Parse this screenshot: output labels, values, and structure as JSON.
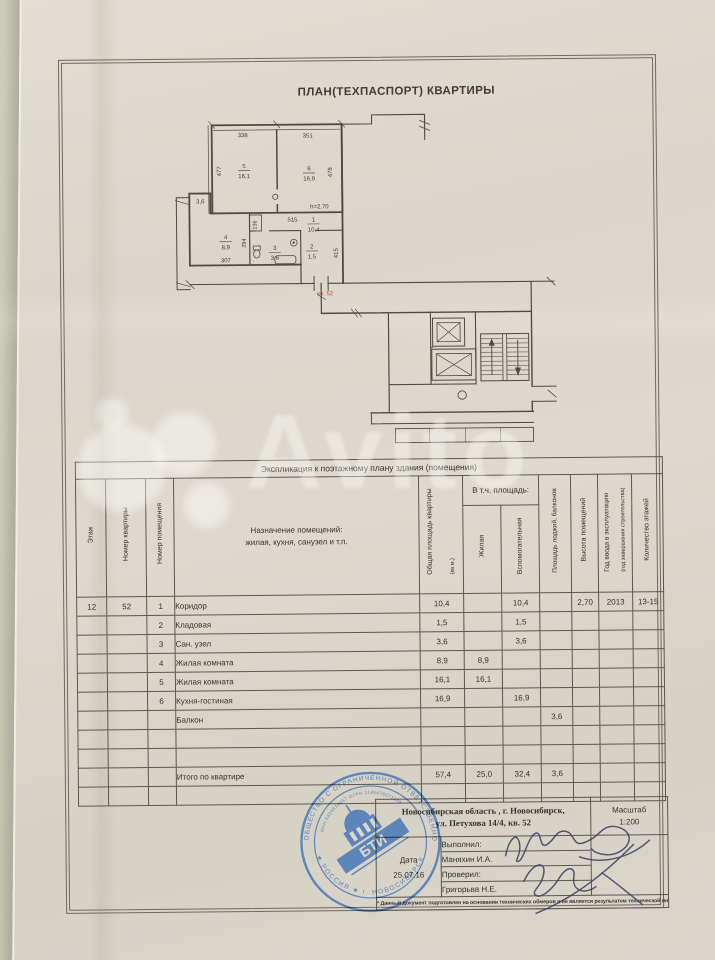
{
  "title": "ПЛАН(ТЕХПАСПОРТ) КВАРТИРЫ",
  "plan": {
    "kv_label": "кв. 52",
    "h_note": "h=2,70",
    "balcony_area": "3,6",
    "rooms": {
      "r5": {
        "num": "5",
        "area": "16,1"
      },
      "r6": {
        "num": "6",
        "area": "16,9"
      },
      "r4": {
        "num": "4",
        "area": "8,9"
      },
      "r3": {
        "num": "3",
        "area": "3,6"
      },
      "r2": {
        "num": "2",
        "area": "1,5"
      },
      "r1": {
        "num": "1",
        "area": "10,4"
      }
    },
    "dims": {
      "top_left": "338",
      "top_right": "351",
      "left": "477",
      "right": "478",
      "hall": "515",
      "hall_v": "415",
      "room4_w": "307",
      "room4_h": "294",
      "duct": "136"
    }
  },
  "table": {
    "caption": "Экспликация к поэтажному плану здания (помещения)",
    "col_floor": "Этаж",
    "col_apt": "Номер квартиры",
    "col_room": "Номер помещения",
    "col_purpose_1": "Назначение помещений:",
    "col_purpose_2": "жилая, кухня, санузел и т.п.",
    "col_total": "Общая площадь квартиры",
    "col_total_sub": "(кв.м.)",
    "col_incl": "В т.ч. площадь:",
    "col_living": "Жилая",
    "col_aux": "Вспомогательная",
    "col_balcony": "Площадь лоджий, балконов",
    "col_height": "Высота помещений",
    "col_year": "Год ввода в эксплуатацию",
    "col_year_sub": "(год завершения строительства)",
    "col_floors": "Количество этажей",
    "rows": [
      {
        "floor": "12",
        "apt": "52",
        "num": "1",
        "name": "Коридор",
        "total": "10,4",
        "living": "",
        "aux": "10,4",
        "balc": "",
        "height": "2,70",
        "year": "2013",
        "floors": "13-15"
      },
      {
        "floor": "",
        "apt": "",
        "num": "2",
        "name": "Кладовая",
        "total": "1,5",
        "living": "",
        "aux": "1,5",
        "balc": "",
        "height": "",
        "year": "",
        "floors": ""
      },
      {
        "floor": "",
        "apt": "",
        "num": "3",
        "name": "Сан. узел",
        "total": "3,6",
        "living": "",
        "aux": "3,6",
        "balc": "",
        "height": "",
        "year": "",
        "floors": ""
      },
      {
        "floor": "",
        "apt": "",
        "num": "4",
        "name": "Жилая комната",
        "total": "8,9",
        "living": "8,9",
        "aux": "",
        "balc": "",
        "height": "",
        "year": "",
        "floors": ""
      },
      {
        "floor": "",
        "apt": "",
        "num": "5",
        "name": "Жилая комната",
        "total": "16,1",
        "living": "16,1",
        "aux": "",
        "balc": "",
        "height": "",
        "year": "",
        "floors": ""
      },
      {
        "floor": "",
        "apt": "",
        "num": "6",
        "name": "Кухня-гостиная",
        "total": "16,9",
        "living": "",
        "aux": "16,9",
        "balc": "",
        "height": "",
        "year": "",
        "floors": ""
      },
      {
        "floor": "",
        "apt": "",
        "num": "",
        "name": "Балкон",
        "total": "",
        "living": "",
        "aux": "",
        "balc": "3,6",
        "height": "",
        "year": "",
        "floors": ""
      },
      {
        "floor": "",
        "apt": "",
        "num": "",
        "name": "",
        "total": "",
        "living": "",
        "aux": "",
        "balc": "",
        "height": "",
        "year": "",
        "floors": ""
      },
      {
        "floor": "",
        "apt": "",
        "num": "",
        "name": "",
        "total": "",
        "living": "",
        "aux": "",
        "balc": "",
        "height": "",
        "year": "",
        "floors": ""
      },
      {
        "floor": "",
        "apt": "",
        "num": "",
        "name": "Итого по квартире",
        "total": "57,4",
        "living": "25,0",
        "aux": "32,4",
        "balc": "3,6",
        "height": "",
        "year": "",
        "floors": ""
      },
      {
        "floor": "",
        "apt": "",
        "num": "",
        "name": "",
        "total": "",
        "living": "",
        "aux": "",
        "balc": "",
        "height": "",
        "year": "",
        "floors": ""
      }
    ]
  },
  "footer": {
    "address1": "Новосибирская область , г. Новосибирск,",
    "address2": "ул. Петухова 14/4, кв. 52",
    "scale_label": "Масштаб",
    "scale_value": "1:200",
    "date_label": "Дата",
    "date_value": "25.07.16",
    "done_label": "Выполнил:",
    "done_name": "Маняхин И.А.",
    "checked_label": "Проверил:",
    "checked_name": "Григорьва Н.Е.",
    "note": "* Данный документ подготовлен на основании технических обмеров и не является результатом технической инвентаризации"
  },
  "stamp": {
    "ring_top": "ОБЩЕСТВО С ОГРАНИЧЕННОЙ ОТВЕТСТВЕННОСТЬЮ",
    "ring_bottom": "★ РОССИЯ ★ г. НОВОСИБИРСК",
    "ring_inner": "ИНН 5404614657  ОГРН 1145476071129",
    "center": "БТИ"
  },
  "colors": {
    "paper": "#dcd7cc",
    "line": "#4e4b43",
    "text": "#3a382f",
    "red": "#b5453d",
    "stamp_blue": "#3f72b8",
    "ink": "#3a4060"
  }
}
